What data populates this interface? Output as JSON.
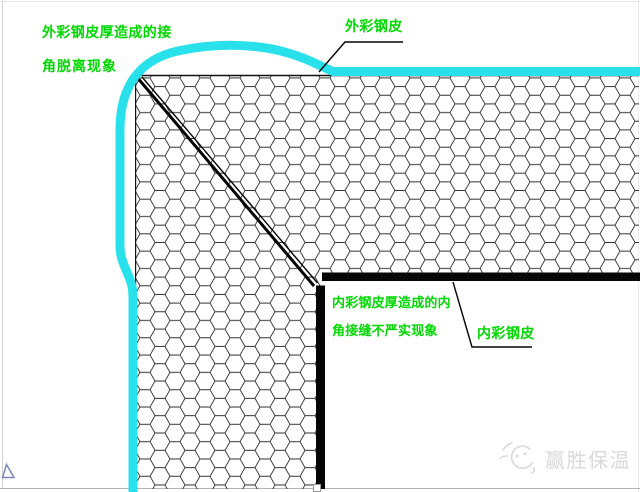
{
  "diagram": {
    "title_context": "corner joint defect detail of insulated panel",
    "labels": {
      "outer_defect_line1": "外彩钢皮厚造成的接",
      "outer_defect_line2": "角脱离现象",
      "outer_sheet": "外彩钢皮",
      "inner_defect_line1": "内彩钢皮厚造成的内",
      "inner_defect_line2": "角接缝不严实现象",
      "inner_sheet": "内彩钢皮"
    },
    "colors": {
      "outer_sheet_cyan": "#29E1EB",
      "label_green": "#00D800",
      "inner_sheet_black": "#060606",
      "hatch_line": "#303030",
      "watermark_gray": "#D9D9D9"
    },
    "watermark": {
      "brand_text": "赢胜保温"
    }
  }
}
